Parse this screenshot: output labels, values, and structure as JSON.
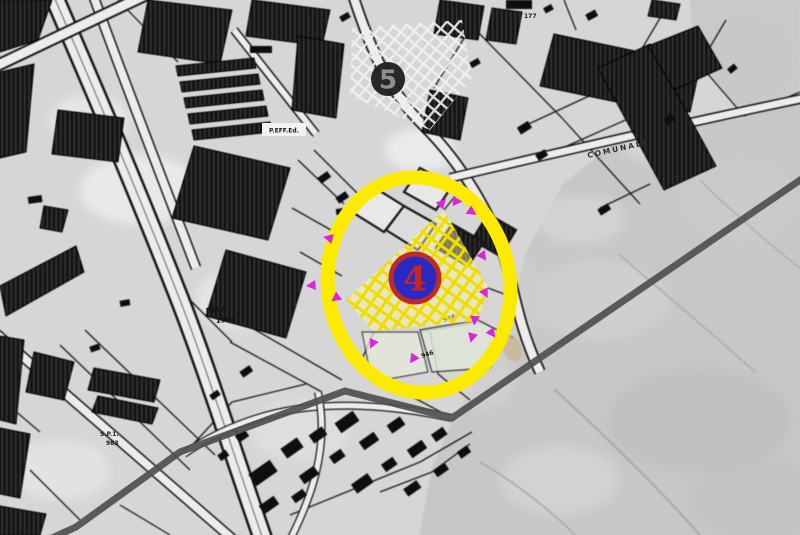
{
  "map": {
    "labels": {
      "building_box": "P.EFF.Ed.",
      "parcel_name": "P.LLA",
      "parcel_number": "1984",
      "road_name_1": "S.P.1.",
      "road_number_1": "983",
      "road_name_2": "COMUNALE",
      "plot_number_1": "177",
      "plot_number_2": "948",
      "plot_number_3": "946"
    }
  },
  "markers": {
    "selected": {
      "label": "4"
    },
    "secondary": {
      "label": "5"
    }
  },
  "colors": {
    "highlight_ellipse": "#FCEA00",
    "parcel_hatch": "#EFDC00",
    "parcel_fill": "rgba(255,250,160,0.45)",
    "survey_flags": "#DB25DB",
    "selected_marker_ring": "#BE2A2A",
    "selected_marker_fill": "#2A2AC2",
    "selected_marker_number": "#C92323",
    "secondary_marker_fill": "#1E1E1E",
    "secondary_marker_number": "#8E8E8E",
    "route_line": "#4F4F4F"
  }
}
